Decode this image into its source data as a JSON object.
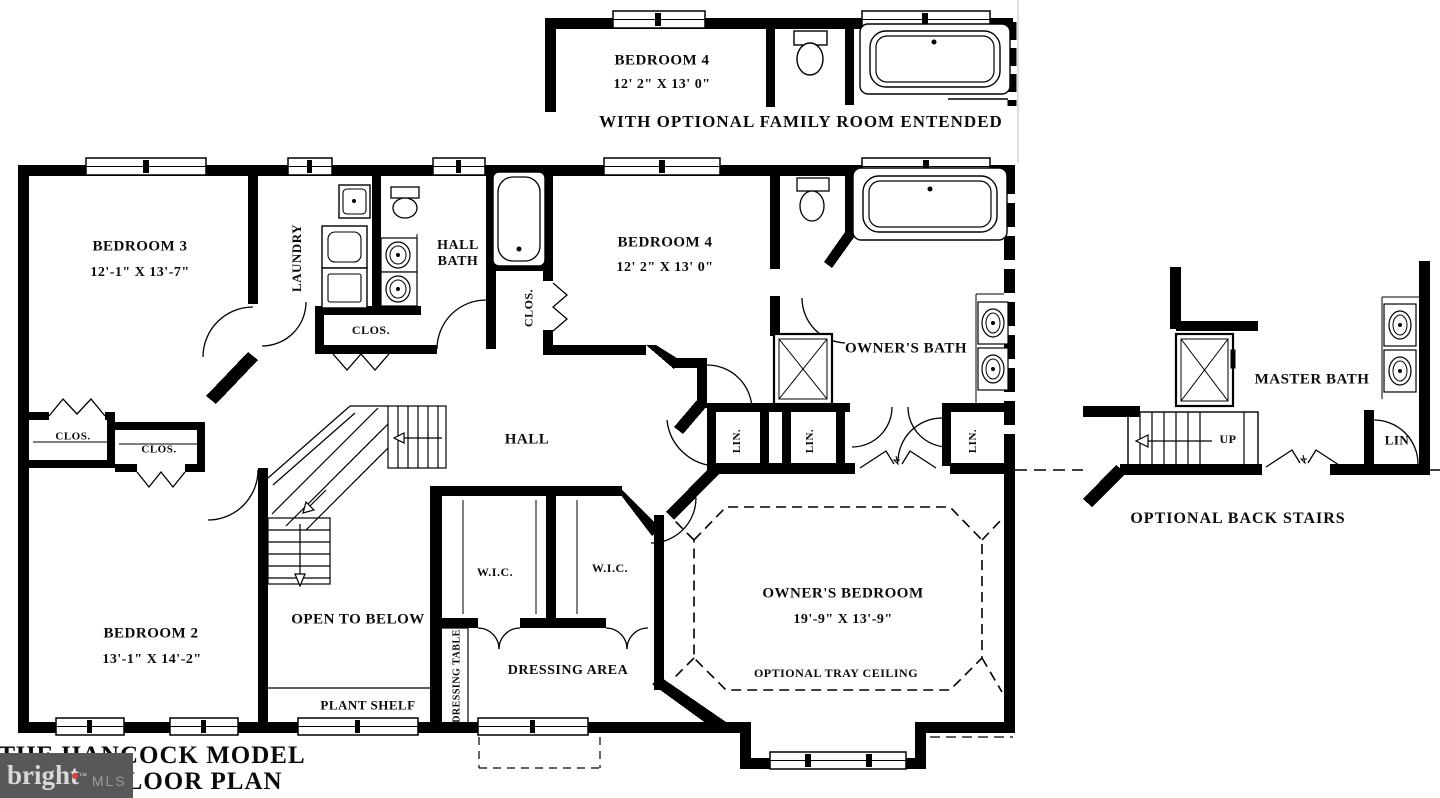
{
  "palette": {
    "wall": "#000000",
    "background": "#ffffff",
    "watermark_bg": "#58585a",
    "watermark_bright": "#d8d8d8",
    "watermark_mls": "#9b9b9d",
    "watermark_dot": "#d9413d",
    "faint_line": "#e0e0e0"
  },
  "captions": {
    "optional_family": "WITH OPTIONAL FAMILY ROOM ENTENDED",
    "optional_back_stairs": "OPTIONAL BACK STAIRS",
    "tray_ceiling": "OPTIONAL TRAY CEILING",
    "plant_shelf": "PLANT SHELF",
    "open_to_below": "OPEN TO BELOW",
    "hall": "HALL",
    "up": "UP",
    "dressing_area": "DRESSING AREA",
    "dressing_table": "DRESSING TABLE"
  },
  "rooms": {
    "bedroom4_optional": {
      "label": "BEDROOM 4",
      "dims": "12' 2\" X 13' 0\""
    },
    "bedroom3": {
      "label": "BEDROOM 3",
      "dims": "12'-1\" X 13'-7\""
    },
    "bedroom4": {
      "label": "BEDROOM 4",
      "dims": "12' 2\" X 13' 0\""
    },
    "bedroom2": {
      "label": "BEDROOM 2",
      "dims": "13'-1\" X 14'-2\""
    },
    "owners_bedroom": {
      "label": "OWNER'S BEDROOM",
      "dims": "19'-9\" X 13'-9\""
    },
    "owners_bath": {
      "label": "OWNER'S BATH"
    },
    "master_bath": {
      "label": "MASTER BATH"
    },
    "hall_bath": {
      "label": "HALL BATH"
    },
    "laundry": {
      "label": "LAUNDRY"
    }
  },
  "closets": {
    "clos": "CLOS.",
    "lin": "LIN.",
    "lin_plain": "LIN",
    "wic": "W.I.C."
  },
  "title": {
    "line1": "THE HANCOCK MODEL",
    "line2": "FLOOR PLAN"
  },
  "watermark": {
    "brand": "bright",
    "suffix": "MLS",
    "tm": "™"
  }
}
